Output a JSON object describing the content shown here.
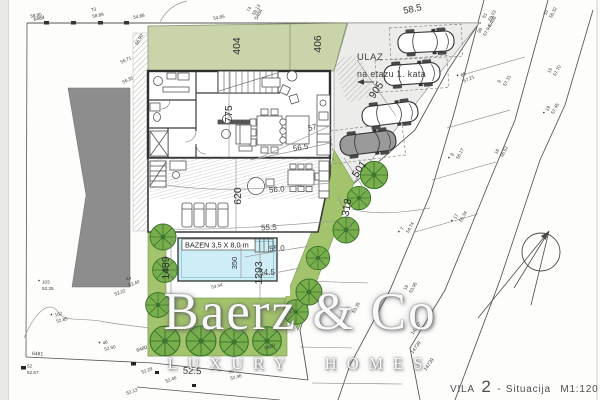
{
  "title": {
    "project": "VILA",
    "number": "2",
    "dash": "-",
    "name": "Situacija",
    "scale": "M1:120"
  },
  "watermark": {
    "brand": "Baerz & Co",
    "tagline": "LUXURY HOMES"
  },
  "pool": {
    "label": "BAZEN 3,5 X 8,0 m"
  },
  "entrance": {
    "line1": "ULAZ",
    "line2": "na etazu 1. kata"
  },
  "dims": {
    "strip_left": "404",
    "strip_right": "406",
    "house_depth": "775",
    "terrace_depth": "620",
    "ramp": "905",
    "pool_width": "350",
    "pool_length": "1293",
    "garden_width": "1489",
    "hedge_upper": "501",
    "hedge_lower": "318",
    "top_width": "58.5",
    "bottom_width": "52.5"
  },
  "contours": {
    "c57": "57",
    "c565": "56.5",
    "c560": "56.0",
    "c555": "55.5",
    "c550": "55.0",
    "c545": "54.5"
  },
  "survey_points": [
    {
      "id": "73",
      "elev": "58.89"
    },
    {
      "id": "",
      "elev": "54.88"
    },
    {
      "id": "",
      "elev": "58.90"
    },
    {
      "id": "74",
      "elev": "58.13"
    },
    {
      "id": "",
      "elev": "54.85"
    },
    {
      "id": "61",
      "elev": "59.03"
    },
    {
      "id": "98",
      "elev": "57.94"
    },
    {
      "id": "10",
      "elev": "58.32"
    },
    {
      "id": "65",
      "elev": "57.21"
    },
    {
      "id": "9",
      "elev": "57.31"
    },
    {
      "id": "15",
      "elev": "57.70"
    },
    {
      "id": "19",
      "elev": "57.45"
    },
    {
      "id": "8",
      "elev": "56.17"
    },
    {
      "id": "16",
      "elev": "56.52"
    },
    {
      "id": "17",
      "elev": "55.34"
    },
    {
      "id": "7",
      "elev": "54.74"
    },
    {
      "id": "18",
      "elev": "53.95"
    },
    {
      "id": "6",
      "elev": "53.35"
    },
    {
      "id": "",
      "elev": "56.90"
    },
    {
      "id": "",
      "elev": "56.71"
    },
    {
      "id": "",
      "elev": "56.35"
    },
    {
      "id": "103",
      "elev": "53.35"
    },
    {
      "id": "102",
      "elev": "52.85"
    },
    {
      "id": "44",
      "elev": "53.40"
    },
    {
      "id": "",
      "elev": "53.22"
    },
    {
      "id": "46",
      "elev": "52.50"
    },
    {
      "id": "52",
      "elev": "52.57"
    },
    {
      "id": "",
      "elev": "52.29"
    },
    {
      "id": "",
      "elev": "52.46"
    },
    {
      "id": "50",
      "elev": "52.46"
    },
    {
      "id": "",
      "elev": "52.13"
    },
    {
      "id": "",
      "elev": "54.54"
    }
  ],
  "parcels": [
    {
      "num": "6484"
    },
    {
      "num": "5484"
    },
    {
      "num": "6488"
    },
    {
      "num": "6481"
    },
    {
      "num": "6480"
    },
    {
      "num": "6480"
    },
    {
      "num": "14737"
    },
    {
      "num": "14739"
    },
    {
      "num": "14739"
    }
  ]
}
